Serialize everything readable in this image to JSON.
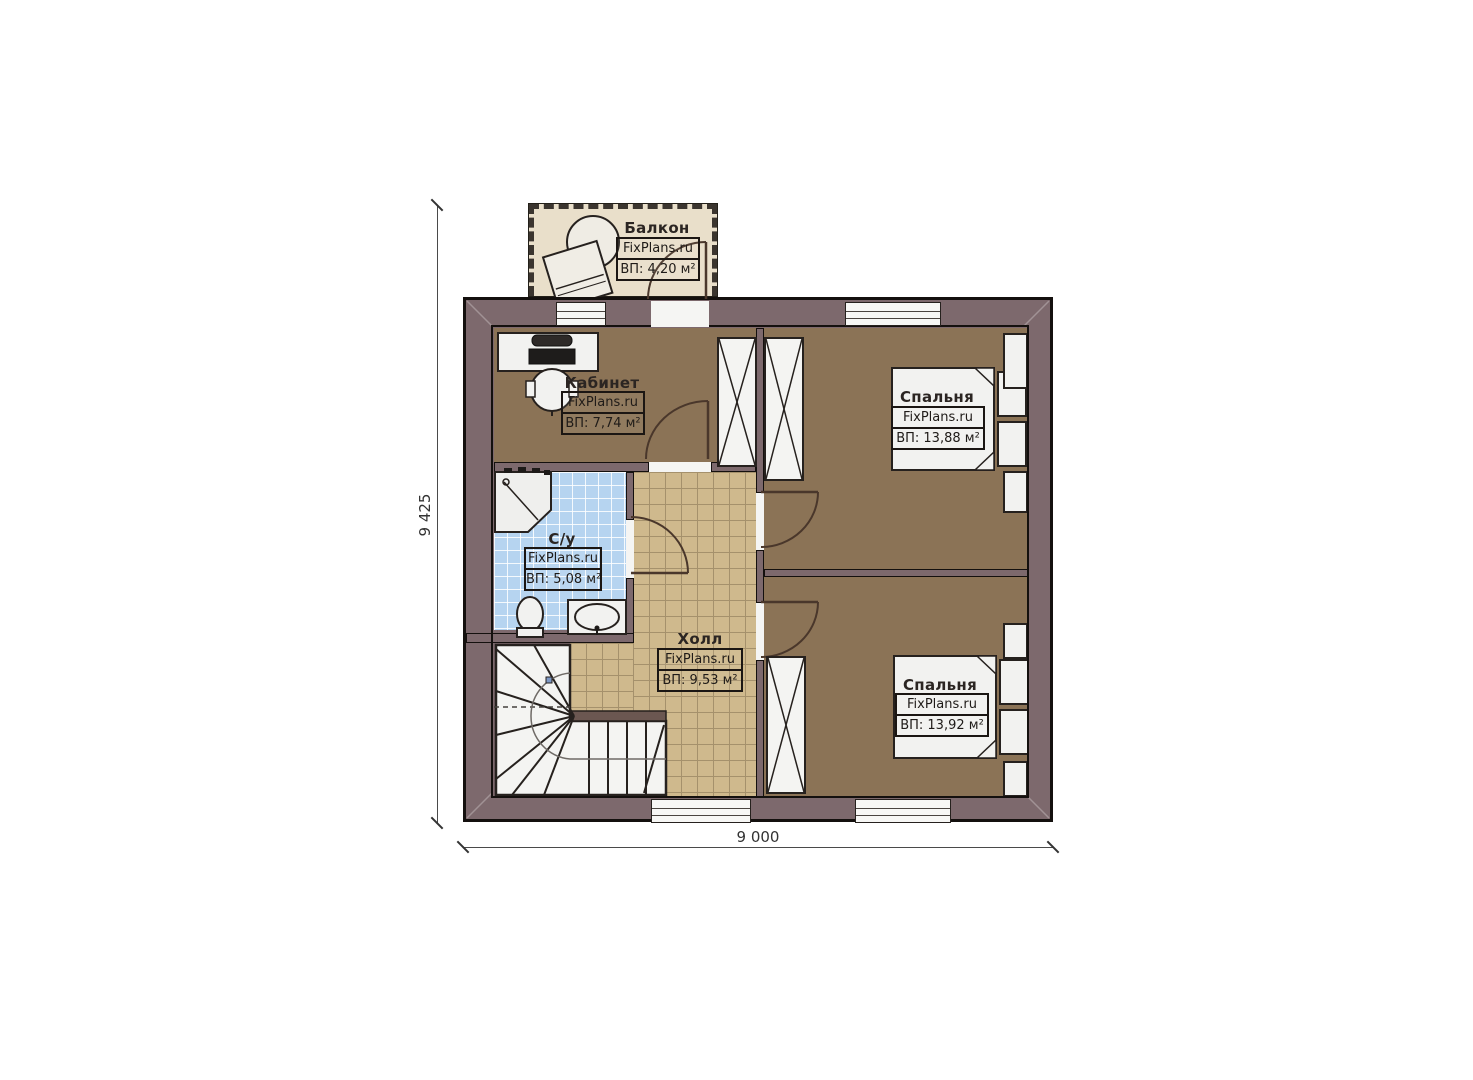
{
  "page": {
    "type": "floor-plan",
    "background": "#ffffff"
  },
  "watermark_site": "FixPlans.ru",
  "dimensions": {
    "left_total": "9 425",
    "bottom_total": "9 000"
  },
  "rooms": {
    "balcony": {
      "name": "Балкон",
      "brand": "FixPlans.ru",
      "area": "ВП: 4,20 м²"
    },
    "office": {
      "name": "Кабинет",
      "brand": "FixPlans.ru",
      "area": "ВП: 7,74 м²"
    },
    "bedroom_top": {
      "name": "Спальня",
      "brand": "FixPlans.ru",
      "area": "ВП: 13,88 м²"
    },
    "bathroom": {
      "name": "С/у",
      "brand": "FixPlans.ru",
      "area": "ВП: 5,08 м²"
    },
    "hall": {
      "name": "Холл",
      "brand": "FixPlans.ru",
      "area": "ВП: 9,53 м²"
    },
    "bedroom_bottom": {
      "name": "Спальня",
      "brand": "FixPlans.ru",
      "area": "ВП: 13,92 м²"
    }
  },
  "colors": {
    "wall": "#7d696d",
    "wood_floor": "#8b7356",
    "hall_tile": "#cfb98d",
    "bath_tile": "#b6d4f0",
    "balcony_floor": "#e9dfca",
    "furniture": "#f2f2f0",
    "outline": "#14100e"
  }
}
